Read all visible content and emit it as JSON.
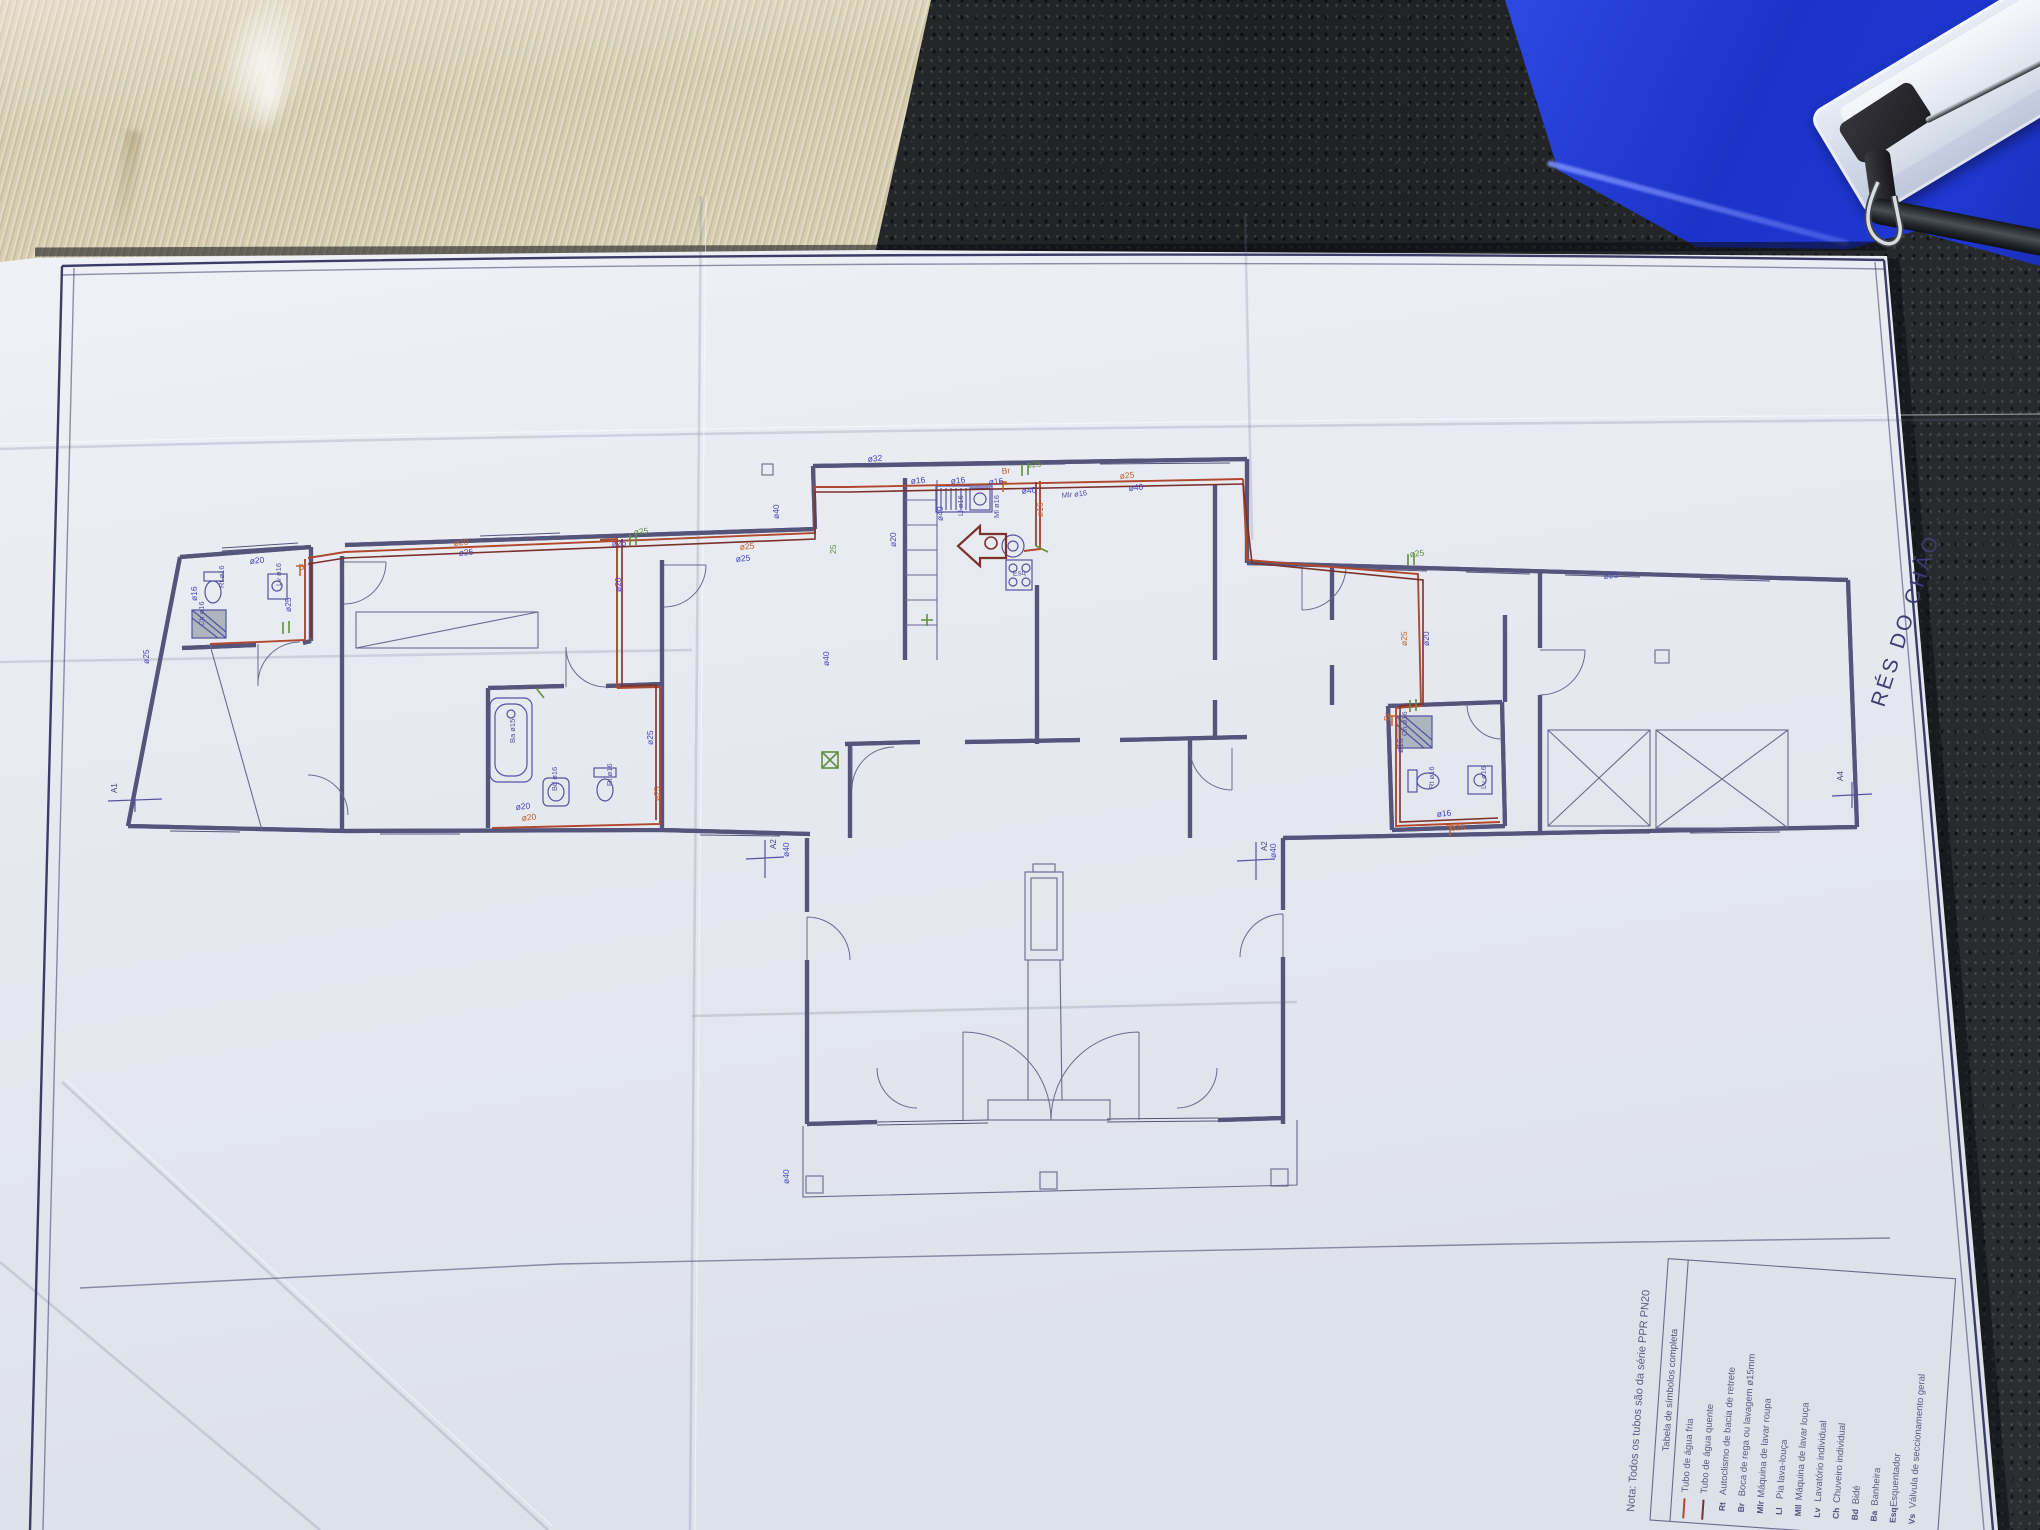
{
  "drawing": {
    "sheet_title": "RÉS DO CHÃO",
    "note": "Nota: Todos os tubos são da série PPR PN20",
    "legend": {
      "title": "Tabela de símbolos completa",
      "rows": [
        {
          "sym": "",
          "label": "Tubo de água fria",
          "line": "#b0482e"
        },
        {
          "sym": "",
          "label": "Tubo de água quente",
          "line": "#7c312c"
        },
        {
          "sym": "Rt",
          "label": "Autoclismo de bacia de retrete"
        },
        {
          "sym": "Br",
          "label": "Boca de rega ou lavagem ø15mm"
        },
        {
          "sym": "Mlr",
          "label": "Máquina de lavar roupa"
        },
        {
          "sym": "Ll",
          "label": "Pia lava-louça"
        },
        {
          "sym": "Mll",
          "label": "Máquina de lavar louça"
        },
        {
          "sym": "Lv",
          "label": "Lavatório individual"
        },
        {
          "sym": "Ch",
          "label": "Chuveiro individual"
        },
        {
          "sym": "Bd",
          "label": "Bidé"
        },
        {
          "sym": "Ba",
          "label": "Banheira"
        },
        {
          "sym": "Esq",
          "label": "Esquentador"
        },
        {
          "sym": "Vs",
          "label": "Válvula de seccionamento geral"
        }
      ]
    },
    "pipe_labels": [
      {
        "t": "ø20",
        "x": 250,
        "y": 564,
        "r": -6,
        "c": "b"
      },
      {
        "t": "ø16",
        "x": 197,
        "y": 601,
        "r": -90,
        "c": "b"
      },
      {
        "t": "ø25",
        "x": 291,
        "y": 612,
        "r": -90,
        "c": "b"
      },
      {
        "t": "ø25",
        "x": 149,
        "y": 664,
        "r": -90,
        "c": "b"
      },
      {
        "t": "ø25",
        "x": 459,
        "y": 556,
        "r": -6,
        "c": "b"
      },
      {
        "t": "ø25",
        "x": 612,
        "y": 547,
        "r": -6,
        "c": "b"
      },
      {
        "t": "ø20",
        "x": 621,
        "y": 592,
        "r": -90,
        "c": "b"
      },
      {
        "t": "ø25",
        "x": 653,
        "y": 745,
        "r": -90,
        "c": "b"
      },
      {
        "t": "ø20",
        "x": 516,
        "y": 810,
        "r": -6,
        "c": "b"
      },
      {
        "t": "ø40",
        "x": 779,
        "y": 519,
        "r": -90,
        "c": "b"
      },
      {
        "t": "ø40",
        "x": 829,
        "y": 666,
        "r": -90,
        "c": "b"
      },
      {
        "t": "ø16",
        "x": 911,
        "y": 484,
        "r": -6,
        "c": "b"
      },
      {
        "t": "ø16",
        "x": 951,
        "y": 484,
        "r": -6,
        "c": "b"
      },
      {
        "t": "ø16",
        "x": 989,
        "y": 485,
        "r": -6,
        "c": "b"
      },
      {
        "t": "ø40",
        "x": 943,
        "y": 521,
        "r": -90,
        "c": "b"
      },
      {
        "t": "ø40",
        "x": 1022,
        "y": 494,
        "r": -6,
        "c": "b"
      },
      {
        "t": "ø40",
        "x": 1129,
        "y": 491,
        "r": -6,
        "c": "b"
      },
      {
        "t": "ø20",
        "x": 896,
        "y": 547,
        "r": -90,
        "c": "b"
      },
      {
        "t": "ø25",
        "x": 736,
        "y": 562,
        "r": -6,
        "c": "b"
      },
      {
        "t": "ø25",
        "x": 1604,
        "y": 579,
        "r": -6,
        "c": "b"
      },
      {
        "t": "ø20",
        "x": 1429,
        "y": 646,
        "r": -90,
        "c": "b"
      },
      {
        "t": "ø16",
        "x": 1403,
        "y": 753,
        "r": -90,
        "c": "b"
      },
      {
        "t": "ø16",
        "x": 1437,
        "y": 817,
        "r": -6,
        "c": "b"
      },
      {
        "t": "ø40",
        "x": 1276,
        "y": 858,
        "r": -90,
        "c": "b"
      },
      {
        "t": "ø40",
        "x": 789,
        "y": 857,
        "r": -90,
        "c": "b"
      },
      {
        "t": "ø40",
        "x": 789,
        "y": 1184,
        "r": -90,
        "c": "b"
      },
      {
        "t": "ø32",
        "x": 868,
        "y": 462,
        "r": -6,
        "c": "b"
      },
      {
        "t": "Br",
        "x": 299,
        "y": 570,
        "r": -6,
        "c": "o"
      },
      {
        "t": "ø20",
        "x": 454,
        "y": 546,
        "r": -6,
        "c": "o"
      },
      {
        "t": "ø25",
        "x": 740,
        "y": 550,
        "r": -6,
        "c": "o"
      },
      {
        "t": "Br",
        "x": 1002,
        "y": 474,
        "r": -6,
        "c": "o"
      },
      {
        "t": "ø25",
        "x": 1120,
        "y": 479,
        "r": -6,
        "c": "o"
      },
      {
        "t": "ø16",
        "x": 1043,
        "y": 517,
        "r": -90,
        "c": "o"
      },
      {
        "t": "ø25",
        "x": 1407,
        "y": 646,
        "r": -90,
        "c": "o"
      },
      {
        "t": "Br",
        "x": 1390,
        "y": 721,
        "r": -90,
        "c": "o"
      },
      {
        "t": "ø16",
        "x": 1451,
        "y": 831,
        "r": -6,
        "c": "o"
      },
      {
        "t": "ø20",
        "x": 522,
        "y": 821,
        "r": -6,
        "c": "o"
      },
      {
        "t": "ø25",
        "x": 660,
        "y": 801,
        "r": -90,
        "c": "o"
      },
      {
        "t": "ø25",
        "x": 634,
        "y": 535,
        "r": -6,
        "c": "g"
      },
      {
        "t": "ø25",
        "x": 1027,
        "y": 468,
        "r": -6,
        "c": "g"
      },
      {
        "t": "ø25",
        "x": 1410,
        "y": 557,
        "r": -6,
        "c": "g"
      },
      {
        "t": "25",
        "x": 836,
        "y": 554,
        "r": -90,
        "c": "g"
      }
    ],
    "fixture_labels": [
      {
        "t": "Rt ø16",
        "x": 224,
        "y": 588,
        "r": -90
      },
      {
        "t": "Lv ø16",
        "x": 281,
        "y": 586,
        "r": -90
      },
      {
        "t": "Ch ø16",
        "x": 204,
        "y": 626,
        "r": -90
      },
      {
        "t": "Ba ø15",
        "x": 515,
        "y": 743,
        "r": -90
      },
      {
        "t": "Bd ø16",
        "x": 557,
        "y": 791,
        "r": -90
      },
      {
        "t": "Rt ø16",
        "x": 612,
        "y": 786,
        "r": -90
      },
      {
        "t": "Ll ø16",
        "x": 963,
        "y": 516,
        "r": -90
      },
      {
        "t": "Ml ø16",
        "x": 999,
        "y": 518,
        "r": -90
      },
      {
        "t": "Esq",
        "x": 1013,
        "y": 576,
        "r": -6
      },
      {
        "t": "Mlr ø16",
        "x": 1062,
        "y": 498,
        "r": -6
      },
      {
        "t": "Ch ø16",
        "x": 1407,
        "y": 736,
        "r": -90
      },
      {
        "t": "Rt ø16",
        "x": 1434,
        "y": 789,
        "r": -90
      },
      {
        "t": "Lv ø16",
        "x": 1486,
        "y": 789,
        "r": -90
      }
    ],
    "vent_labels": [
      {
        "t": "A1",
        "x": 117,
        "y": 793,
        "r": -90
      },
      {
        "t": "A2",
        "x": 776,
        "y": 849,
        "r": -90
      },
      {
        "t": "A2",
        "x": 1267,
        "y": 851,
        "r": -90
      },
      {
        "t": "A4",
        "x": 1843,
        "y": 781,
        "r": -90
      }
    ],
    "colors": {
      "cold_pipe": "#b0482e",
      "hot_pipe": "#7c312c",
      "wall_line": "#55557c",
      "frame_line": "#3c3c68",
      "label_blue": "#4444bc",
      "label_orange": "#bf5f2e",
      "label_green": "#5f8f3e",
      "paper": "#e8eaf1",
      "folder_blue": "#1f37d0"
    }
  }
}
